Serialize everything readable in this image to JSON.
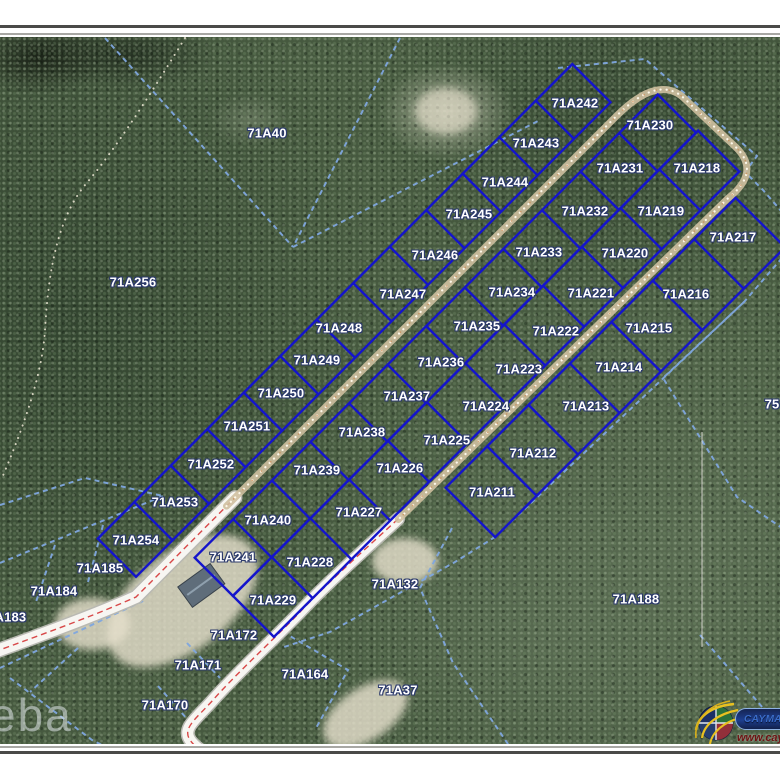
{
  "map": {
    "type": "cadastral-parcel-aerial-map",
    "block_prefix": "71A",
    "colors": {
      "parcel_line": "#1414cc",
      "boundary_dashed": "#7fa6de",
      "road_fill": "#f7f6f2",
      "road_centerline": "#d84848",
      "track_tan": "#cfc0a0",
      "label_text": "#ffffff",
      "label_outline": "#2c3a6b",
      "vegetation_base": "#46593f"
    },
    "subdivision_labels": [
      {
        "id": "71A242",
        "x": 575,
        "y": 103
      },
      {
        "id": "71A243",
        "x": 536,
        "y": 143
      },
      {
        "id": "71A244",
        "x": 505,
        "y": 182
      },
      {
        "id": "71A245",
        "x": 469,
        "y": 214
      },
      {
        "id": "71A246",
        "x": 435,
        "y": 255
      },
      {
        "id": "71A247",
        "x": 403,
        "y": 294
      },
      {
        "id": "71A248",
        "x": 339,
        "y": 328
      },
      {
        "id": "71A249",
        "x": 317,
        "y": 360
      },
      {
        "id": "71A250",
        "x": 281,
        "y": 393
      },
      {
        "id": "71A251",
        "x": 247,
        "y": 426
      },
      {
        "id": "71A252",
        "x": 211,
        "y": 464
      },
      {
        "id": "71A253",
        "x": 175,
        "y": 502
      },
      {
        "id": "71A254",
        "x": 136,
        "y": 540
      },
      {
        "id": "71A230",
        "x": 650,
        "y": 125
      },
      {
        "id": "71A231",
        "x": 620,
        "y": 168
      },
      {
        "id": "71A232",
        "x": 585,
        "y": 211
      },
      {
        "id": "71A233",
        "x": 539,
        "y": 252
      },
      {
        "id": "71A234",
        "x": 512,
        "y": 292
      },
      {
        "id": "71A235",
        "x": 477,
        "y": 326
      },
      {
        "id": "71A236",
        "x": 441,
        "y": 362
      },
      {
        "id": "71A237",
        "x": 407,
        "y": 396
      },
      {
        "id": "71A238",
        "x": 362,
        "y": 432
      },
      {
        "id": "71A239",
        "x": 317,
        "y": 470
      },
      {
        "id": "71A240",
        "x": 268,
        "y": 520
      },
      {
        "id": "71A241",
        "x": 233,
        "y": 557
      },
      {
        "id": "71A218",
        "x": 697,
        "y": 168
      },
      {
        "id": "71A219",
        "x": 661,
        "y": 211
      },
      {
        "id": "71A220",
        "x": 625,
        "y": 253
      },
      {
        "id": "71A221",
        "x": 591,
        "y": 293
      },
      {
        "id": "71A222",
        "x": 556,
        "y": 331
      },
      {
        "id": "71A223",
        "x": 519,
        "y": 369
      },
      {
        "id": "71A224",
        "x": 486,
        "y": 406
      },
      {
        "id": "71A225",
        "x": 447,
        "y": 440
      },
      {
        "id": "71A226",
        "x": 400,
        "y": 468
      },
      {
        "id": "71A227",
        "x": 359,
        "y": 512
      },
      {
        "id": "71A228",
        "x": 310,
        "y": 562
      },
      {
        "id": "71A229",
        "x": 273,
        "y": 600
      },
      {
        "id": "71A217",
        "x": 733,
        "y": 237
      },
      {
        "id": "71A216",
        "x": 686,
        "y": 294
      },
      {
        "id": "71A215",
        "x": 649,
        "y": 328
      },
      {
        "id": "71A214",
        "x": 619,
        "y": 367
      },
      {
        "id": "71A213",
        "x": 586,
        "y": 406
      },
      {
        "id": "71A212",
        "x": 533,
        "y": 453
      },
      {
        "id": "71A211",
        "x": 492,
        "y": 492
      }
    ],
    "surrounding_labels": [
      {
        "id": "71A40",
        "x": 267,
        "y": 133
      },
      {
        "id": "71A256",
        "x": 133,
        "y": 282
      },
      {
        "id": "71A185",
        "x": 100,
        "y": 568
      },
      {
        "id": "71A184",
        "x": 54,
        "y": 591
      },
      {
        "id": "71A183",
        "x": 3,
        "y": 617
      },
      {
        "id": "71A172",
        "x": 234,
        "y": 635
      },
      {
        "id": "71A171",
        "x": 198,
        "y": 665
      },
      {
        "id": "71A170",
        "x": 165,
        "y": 705
      },
      {
        "id": "71A164",
        "x": 305,
        "y": 674
      },
      {
        "id": "71A132",
        "x": 395,
        "y": 584
      },
      {
        "id": "71A37",
        "x": 398,
        "y": 690
      },
      {
        "id": "71A188",
        "x": 636,
        "y": 599
      },
      {
        "id": "75",
        "x": 772,
        "y": 404
      }
    ],
    "watermark_text": "eba"
  },
  "logo": {
    "name": "cayman-land-info-logo",
    "banner_text": "CAYMANLAN",
    "url_text": "www.caym"
  }
}
